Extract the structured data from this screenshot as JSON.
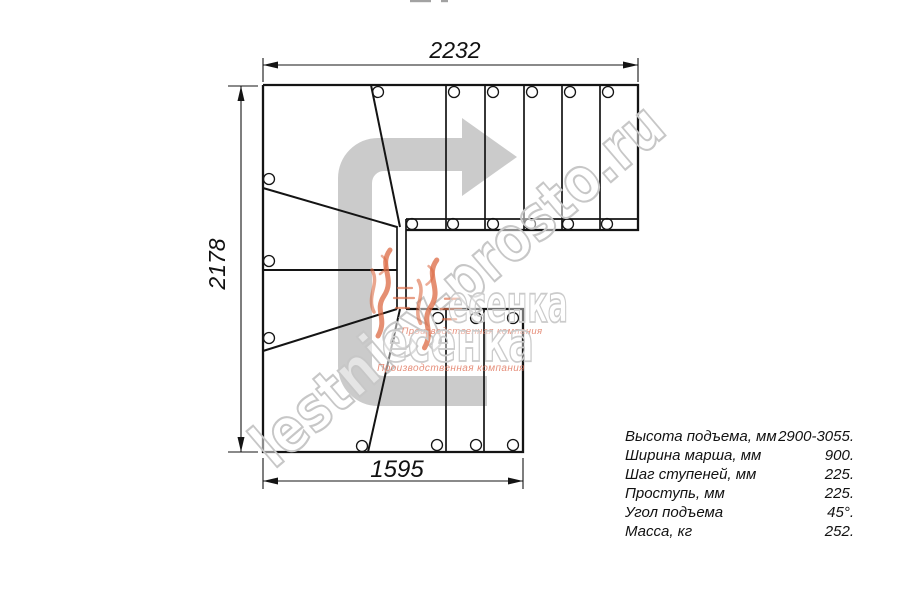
{
  "diagram": {
    "type": "stair-plan-top-view",
    "dimensions": {
      "top": "2232",
      "left": "2178",
      "bottom": "1595"
    },
    "watermark": {
      "site": "lestnicy-prosto.ru",
      "logo_word": "есенка",
      "logo_tagline": "Производственная компания"
    },
    "specs": [
      {
        "label": "Высота подъема, мм",
        "value": "2900-3055."
      },
      {
        "label": "Ширина марша, мм",
        "value": "900."
      },
      {
        "label": "Шаг ступеней, мм",
        "value": "225."
      },
      {
        "label": "Проступь, мм",
        "value": "225."
      },
      {
        "label": "Угол подъема",
        "value": "45°."
      },
      {
        "label": "Масса, кг",
        "value": "252."
      }
    ],
    "colors": {
      "line": "#141414",
      "arrow_fill": "#cbcbcb",
      "watermark_stroke": "#c7c7c7",
      "logo_orange": "#dc6a43",
      "tagline_orange": "#e0735a"
    }
  }
}
